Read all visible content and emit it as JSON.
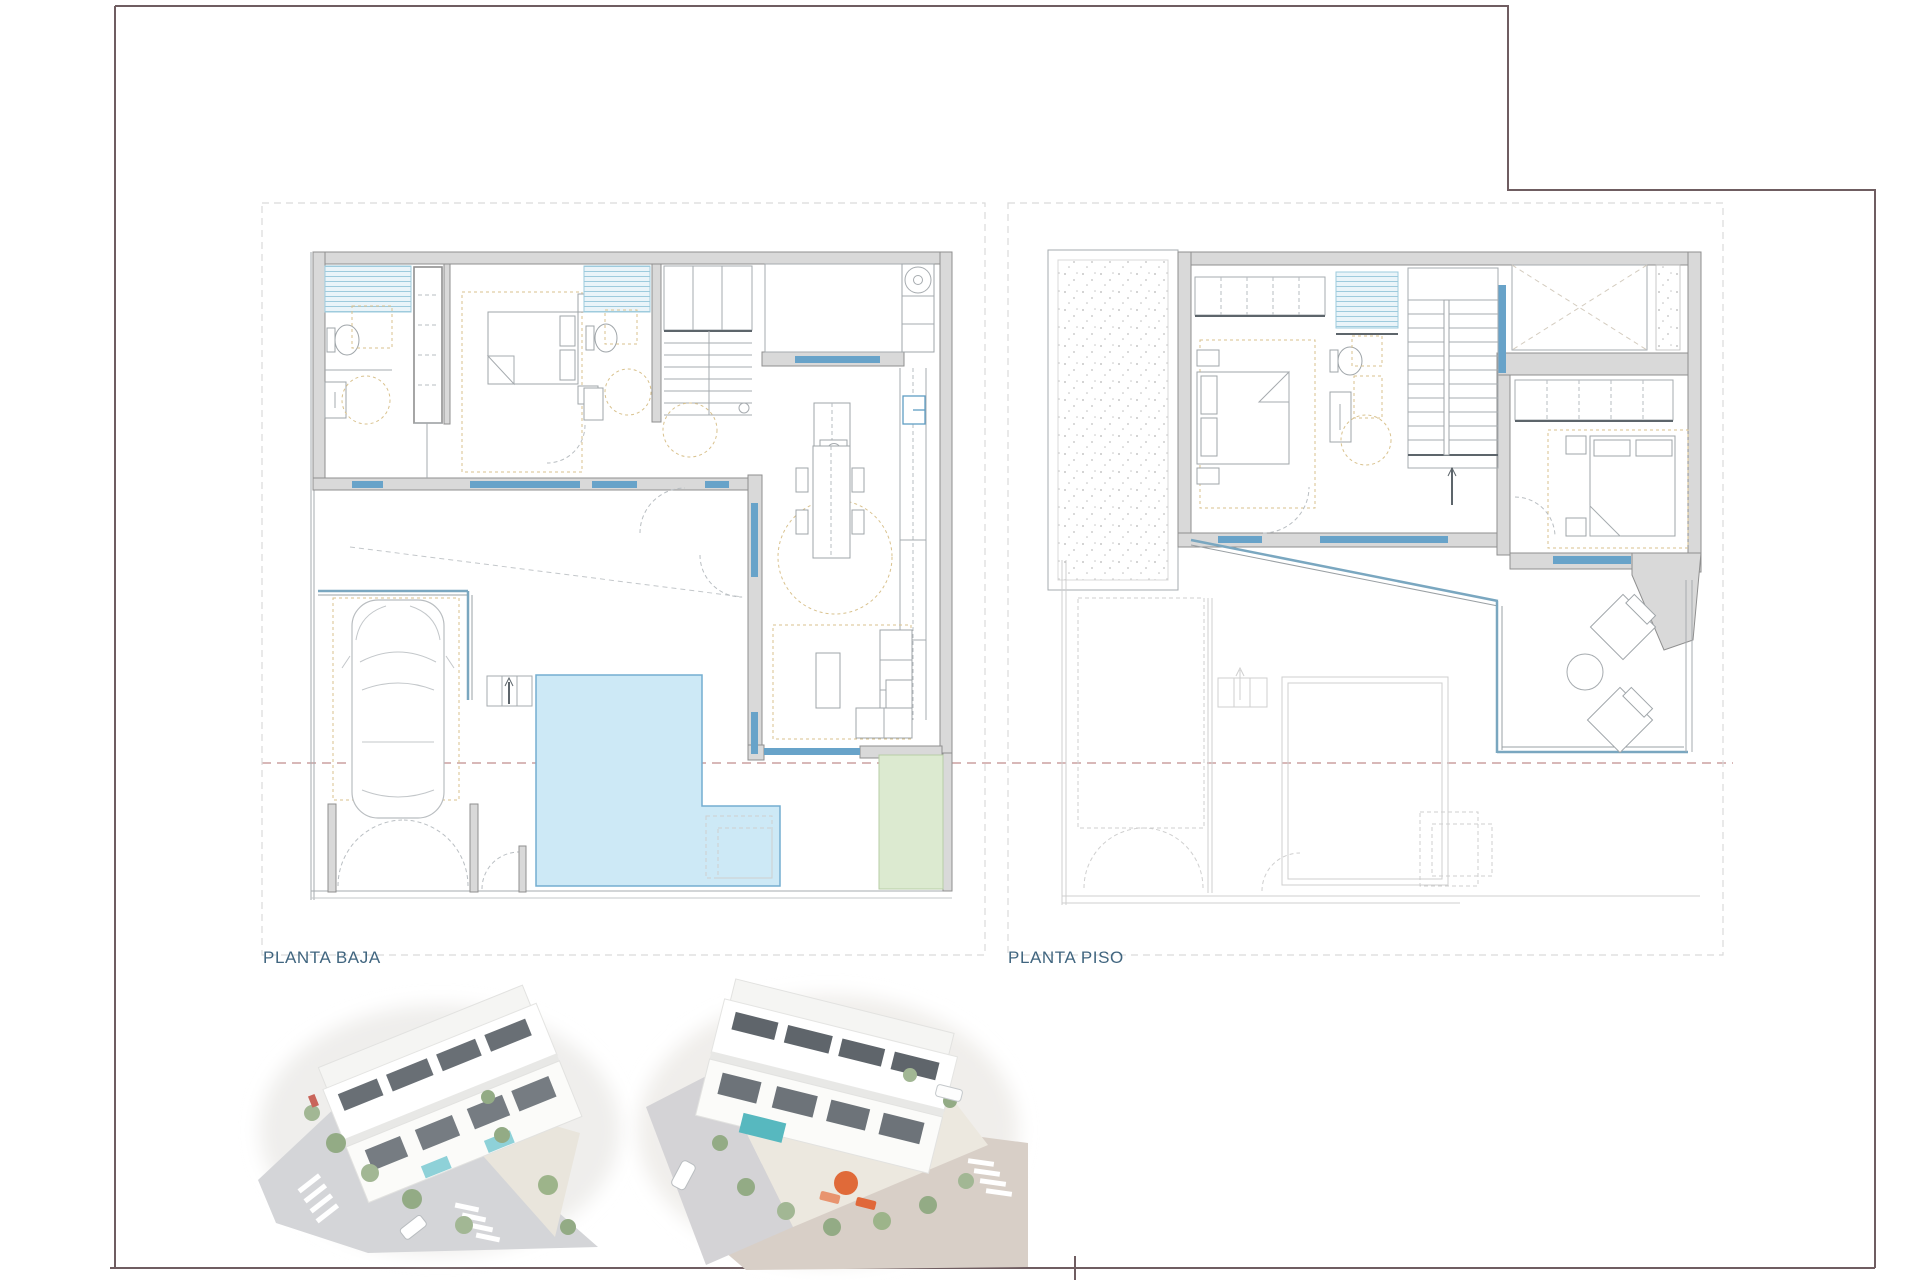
{
  "sheet": {
    "type": "architectural-plan-sheet",
    "frame_color": "#6f5d61",
    "background": "#ffffff"
  },
  "labels": {
    "planta_baja": "PLANTA BAJA",
    "planta_piso": "PLANTA PISO"
  },
  "plans": {
    "planta_baja": {
      "label": "PLANTA BAJA",
      "features": [
        "bathroom-1",
        "bedroom-1",
        "bathroom-2",
        "staircase",
        "laundry-patio",
        "kitchen-island",
        "dining-table",
        "sofa-set",
        "carport-car",
        "swimming-pool",
        "lawn-patch",
        "entry-gates"
      ]
    },
    "planta_piso": {
      "label": "PLANTA PISO",
      "features": [
        "solarium",
        "bedroom-2",
        "bathroom-3",
        "staircase",
        "void-cross",
        "wardrobes",
        "bedroom-3",
        "terrace-lounge",
        "ghost-ground-floor"
      ]
    }
  },
  "colors": {
    "wall_fill": "#d9d9d9",
    "wall_stroke": "#8f8f8f",
    "window_blue": "#68a3c9",
    "pool_fill": "#cde9f6",
    "lawn_fill": "#dcead0",
    "furniture_tan": "#d9c28e",
    "datum_red": "#c08e8e",
    "label_blue": "#40657f",
    "render_street_gray": "#d4d5d8",
    "render_street_beige": "#d8cfc7",
    "render_pool_teal": "#7fc9d2",
    "render_tree_green": "#93ab85",
    "render_accent_orange": "#e06a39"
  }
}
